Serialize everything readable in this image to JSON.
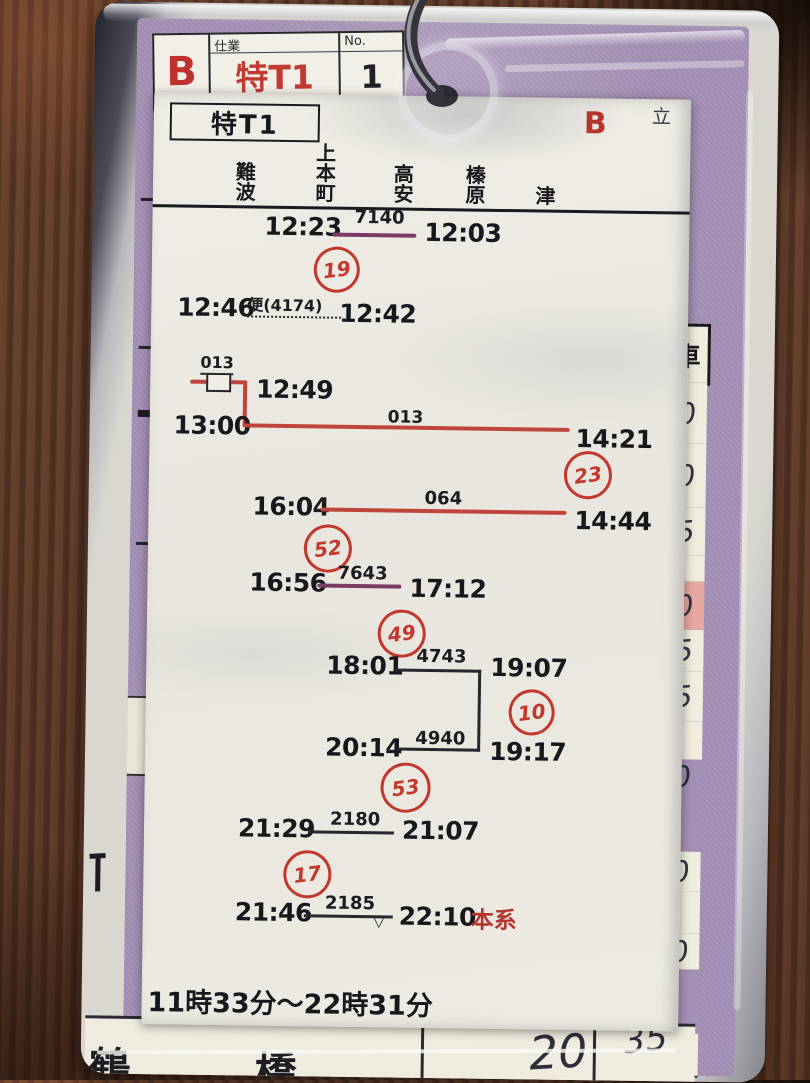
{
  "tag": {
    "grade": "B",
    "assignment_label": "仕業",
    "assignment_value": "特T1",
    "number_label": "No.",
    "number_value": "1"
  },
  "paper": {
    "duty_title": "特T1",
    "grade": "B",
    "corner_mark": "立",
    "stations": [
      "難波",
      "上本町",
      "高安",
      "榛原",
      "津"
    ],
    "legs": {
      "l1": {
        "dep": "12:23",
        "train": "7140",
        "arr": "12:03",
        "badge": "19"
      },
      "l2": {
        "dep": "12:46",
        "train": "便(4174)",
        "arr": "12:42"
      },
      "l3a": {
        "train": "013",
        "time": "12:49"
      },
      "l3b": {
        "dep": "13:00",
        "train": "013",
        "arr": "14:21",
        "badge": "23"
      },
      "l4": {
        "dep": "16:04",
        "train": "064",
        "arr": "14:44",
        "badge": "52"
      },
      "l5": {
        "dep": "16:56",
        "train": "7643",
        "arr": "17:12",
        "badge": "49"
      },
      "l6": {
        "dep": "18:01",
        "train": "4743",
        "arr": "19:07",
        "badge": "10"
      },
      "l7": {
        "dep": "20:14",
        "train": "4940",
        "arr": "19:17",
        "badge": "53"
      },
      "l8": {
        "dep": "21:29",
        "train": "2180",
        "arr": "21:07",
        "badge": "17"
      },
      "l9": {
        "dep": "21:46",
        "train": "2185",
        "arr": "22:10",
        "note": "本系"
      }
    },
    "duty_span": "11時33分～22時31分"
  },
  "base_card": {
    "column_header": "車",
    "right_cells": [
      "0",
      "0",
      "5",
      "",
      "0",
      "5",
      "5",
      "",
      "0",
      "0",
      "",
      "0",
      "",
      "5"
    ],
    "bottom_cells": {
      "left_station": "鶴",
      "mid_station": "橋",
      "value_a": "20",
      "value_b": "35"
    }
  },
  "colors": {
    "red": "#c2382d",
    "red_line": "#c0443c",
    "purple_line": "#7b3a66",
    "pink_cell": "#e7a8a2",
    "card_purple": "#a48fb5"
  }
}
